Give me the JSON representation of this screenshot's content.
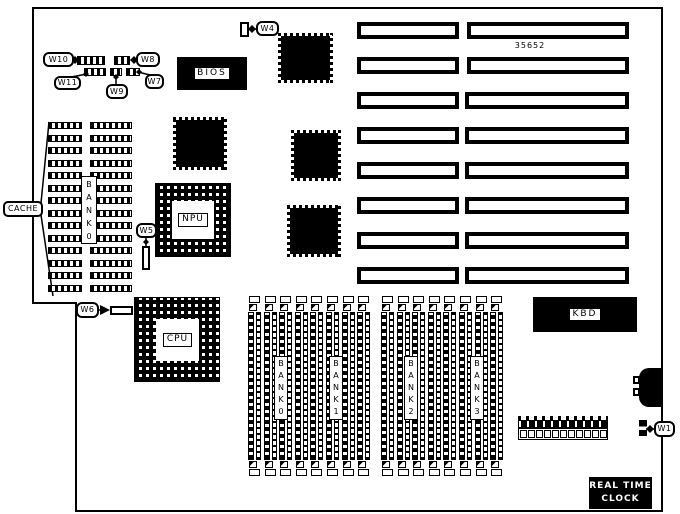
{
  "board": {
    "part_number": "35652",
    "components": {
      "cache": "CACHE",
      "bios": "BIOS",
      "npu": "NPU",
      "cpu": "CPU",
      "kbd": "KBD",
      "rtc": [
        "REAL TIME",
        "CLOCK"
      ],
      "cache_bank": "BANK0",
      "memory_banks": [
        "BANK0",
        "BANK1",
        "BANK2",
        "BANK3"
      ]
    },
    "jumpers": {
      "w1": "W1",
      "w4": "W4",
      "w5": "W5",
      "w6": "W6",
      "w7": "W7",
      "w8": "W8",
      "w9": "W9",
      "w10": "W10",
      "w11": "W11"
    },
    "counts": {
      "expansion_slots": 8,
      "simm_slots_per_group": 8,
      "cache_rows": 14,
      "pin_header_cells": 11
    }
  }
}
